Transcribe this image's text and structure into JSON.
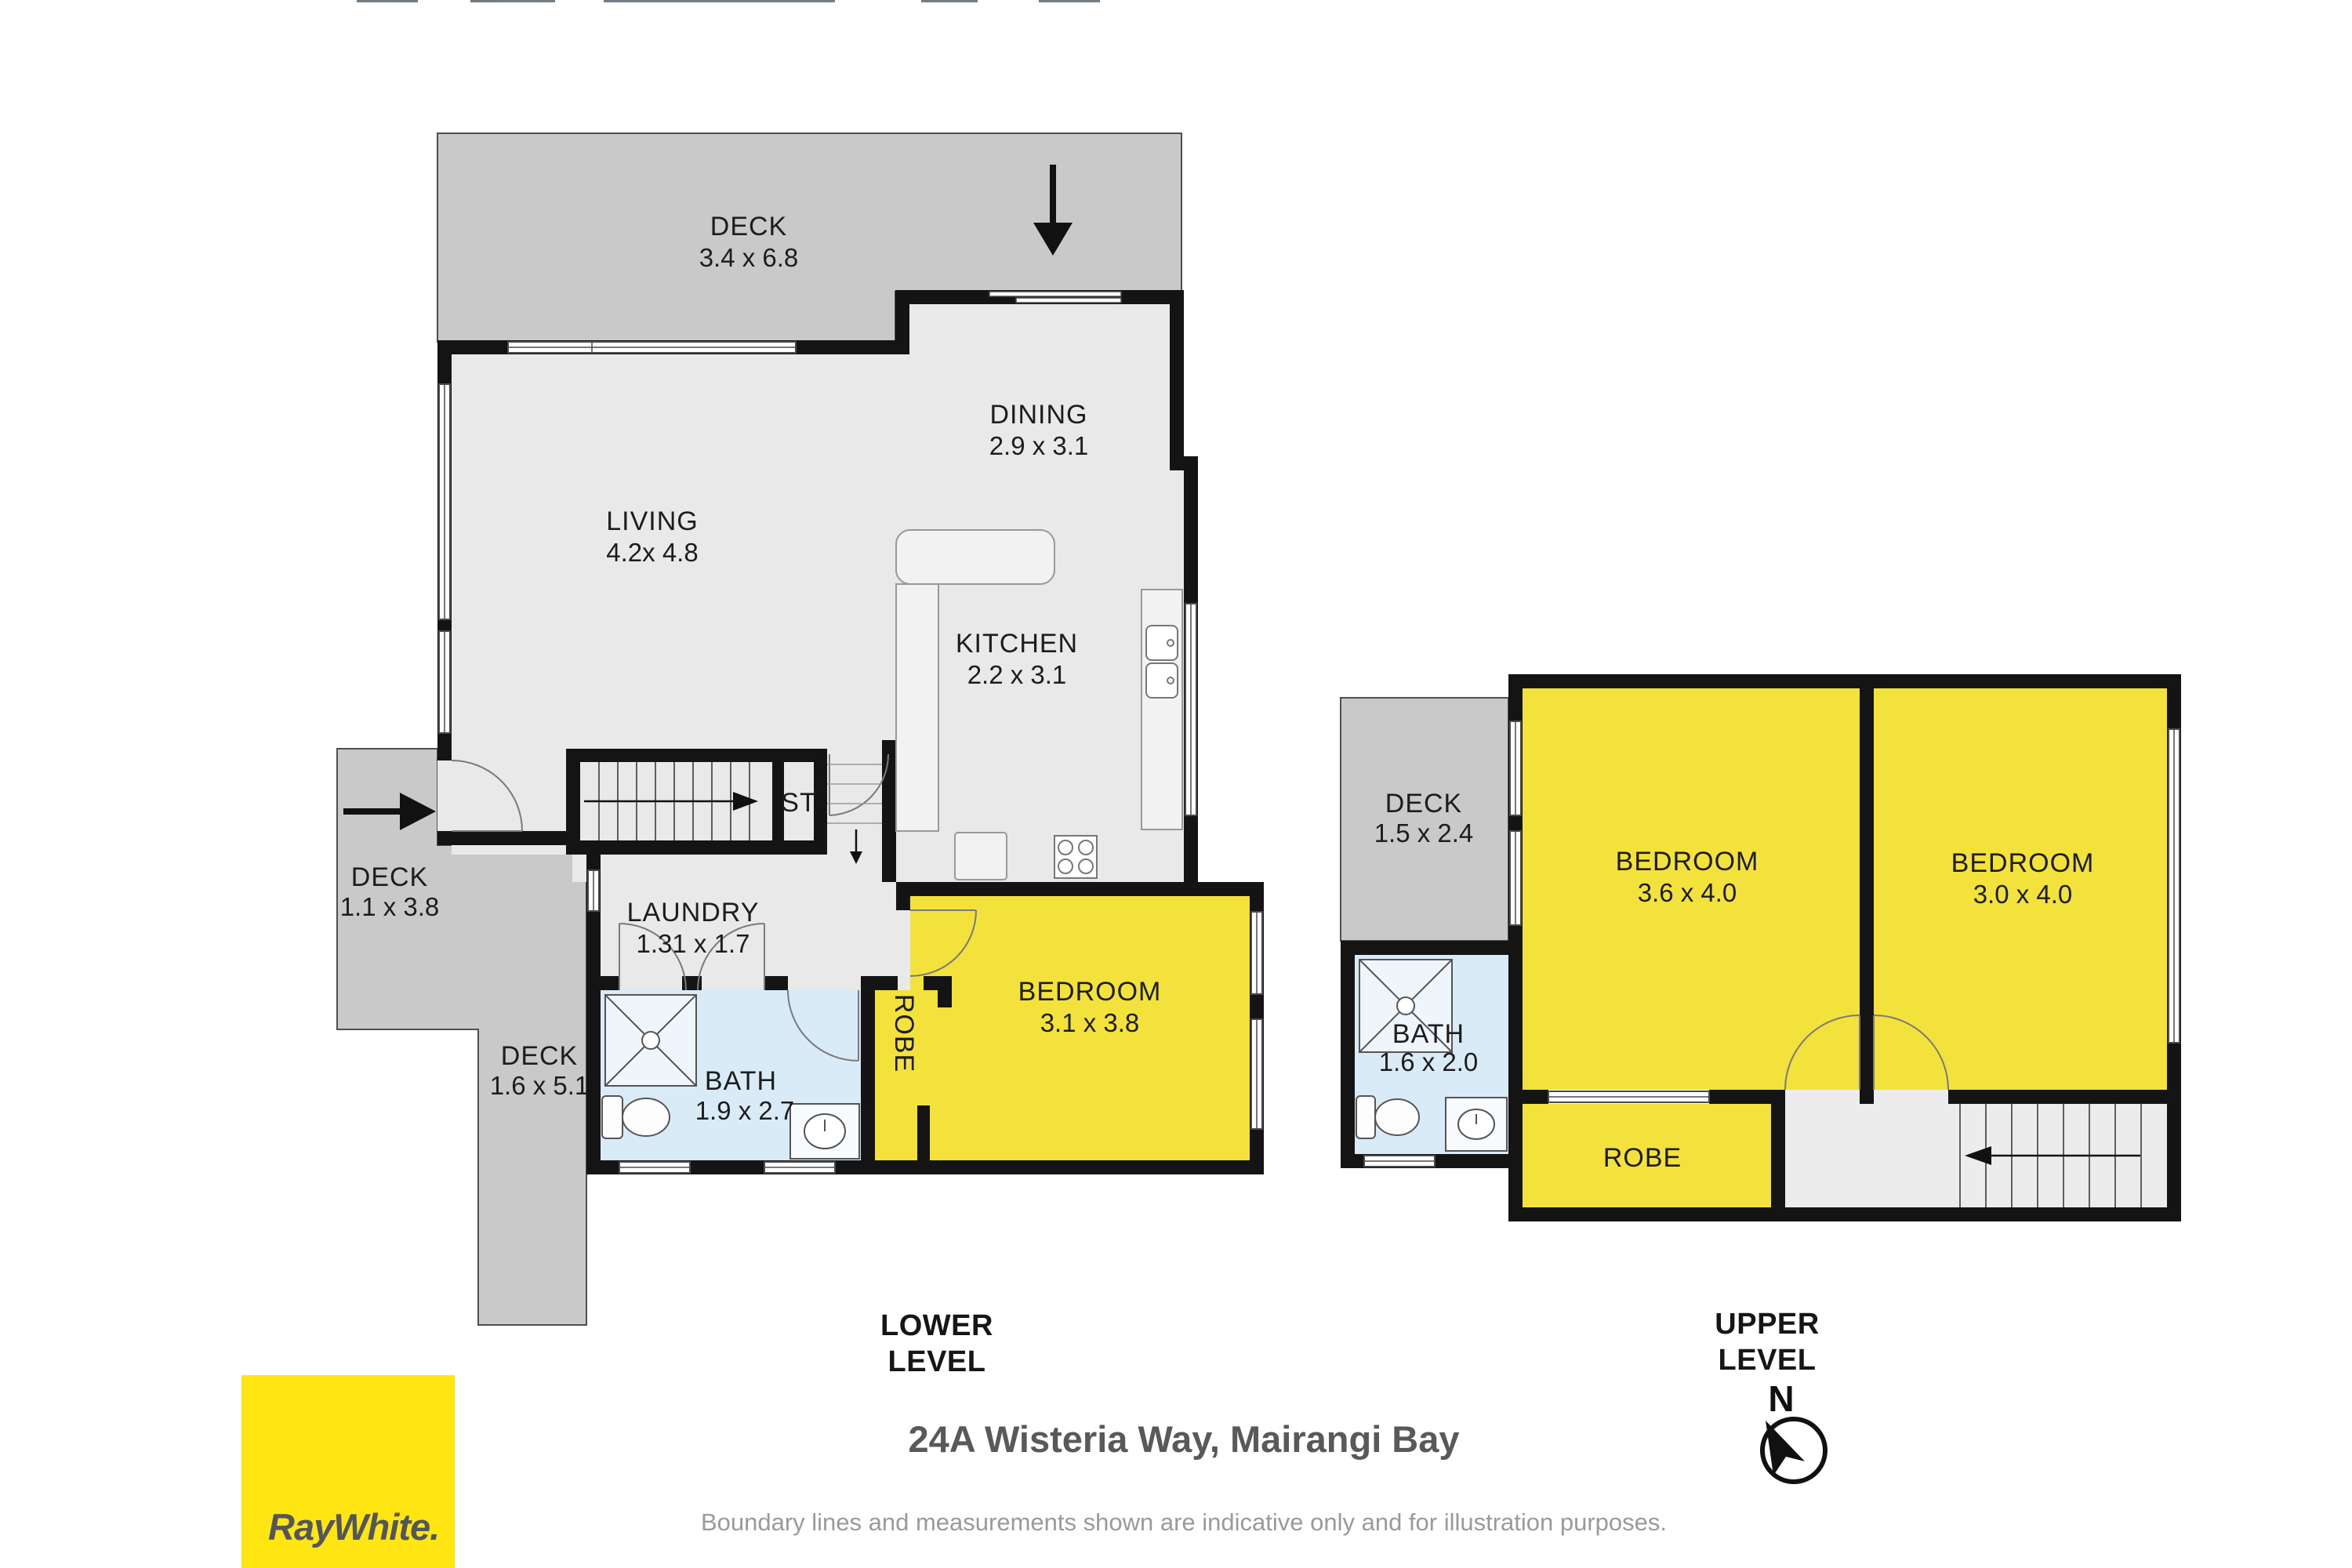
{
  "footer": {
    "title": "24A Wisteria Way, Mairangi Bay",
    "disclaimer": "Boundary lines and measurements shown are indicative only and for illustration purposes.",
    "lower_level": {
      "line1": "LOWER",
      "line2": "LEVEL"
    },
    "upper_level": {
      "line1": "UPPER",
      "line2": "LEVEL"
    }
  },
  "branding": {
    "agency_wordmark": "RayWhite.",
    "logo_bg": "#ffe512",
    "logo_text_color": "#53565a"
  },
  "compass": {
    "label": "N"
  },
  "lower": {
    "deck_top": {
      "name": "DECK",
      "dims": "3.4 x 6.8"
    },
    "dining": {
      "name": "DINING",
      "dims": "2.9 x 3.1"
    },
    "living": {
      "name": "LIVING",
      "dims": "4.2x 4.8"
    },
    "kitchen": {
      "name": "KITCHEN",
      "dims": "2.2 x 3.1"
    },
    "stairs_label": "ST",
    "laundry": {
      "name": "LAUNDRY",
      "dims": "1.31 x 1.7"
    },
    "bath": {
      "name": "BATH",
      "dims": "1.9 x 2.7"
    },
    "robe_label": "ROBE",
    "bedroom": {
      "name": "BEDROOM",
      "dims": "3.1 x 3.8"
    },
    "deck_left": {
      "name": "DECK",
      "dims": "1.1 x 3.8"
    },
    "deck_bottom": {
      "name": "DECK",
      "dims": "1.6 x 5.1"
    }
  },
  "upper": {
    "deck": {
      "name": "DECK",
      "dims": "1.5 x 2.4"
    },
    "bedroom1": {
      "name": "BEDROOM",
      "dims": "3.6 x 4.0"
    },
    "bedroom2": {
      "name": "BEDROOM",
      "dims": "3.0 x 4.0"
    },
    "bath": {
      "name": "BATH",
      "dims": "1.6 x 2.0"
    },
    "robe_label": "ROBE"
  },
  "colors": {
    "deck": "#c9c9c9",
    "floor": "#e9e9e9",
    "wall": "#141414",
    "room_yellow": "#f3e13c",
    "bath_blue": "#d9ebf7",
    "stair_floor": "#ececec"
  }
}
